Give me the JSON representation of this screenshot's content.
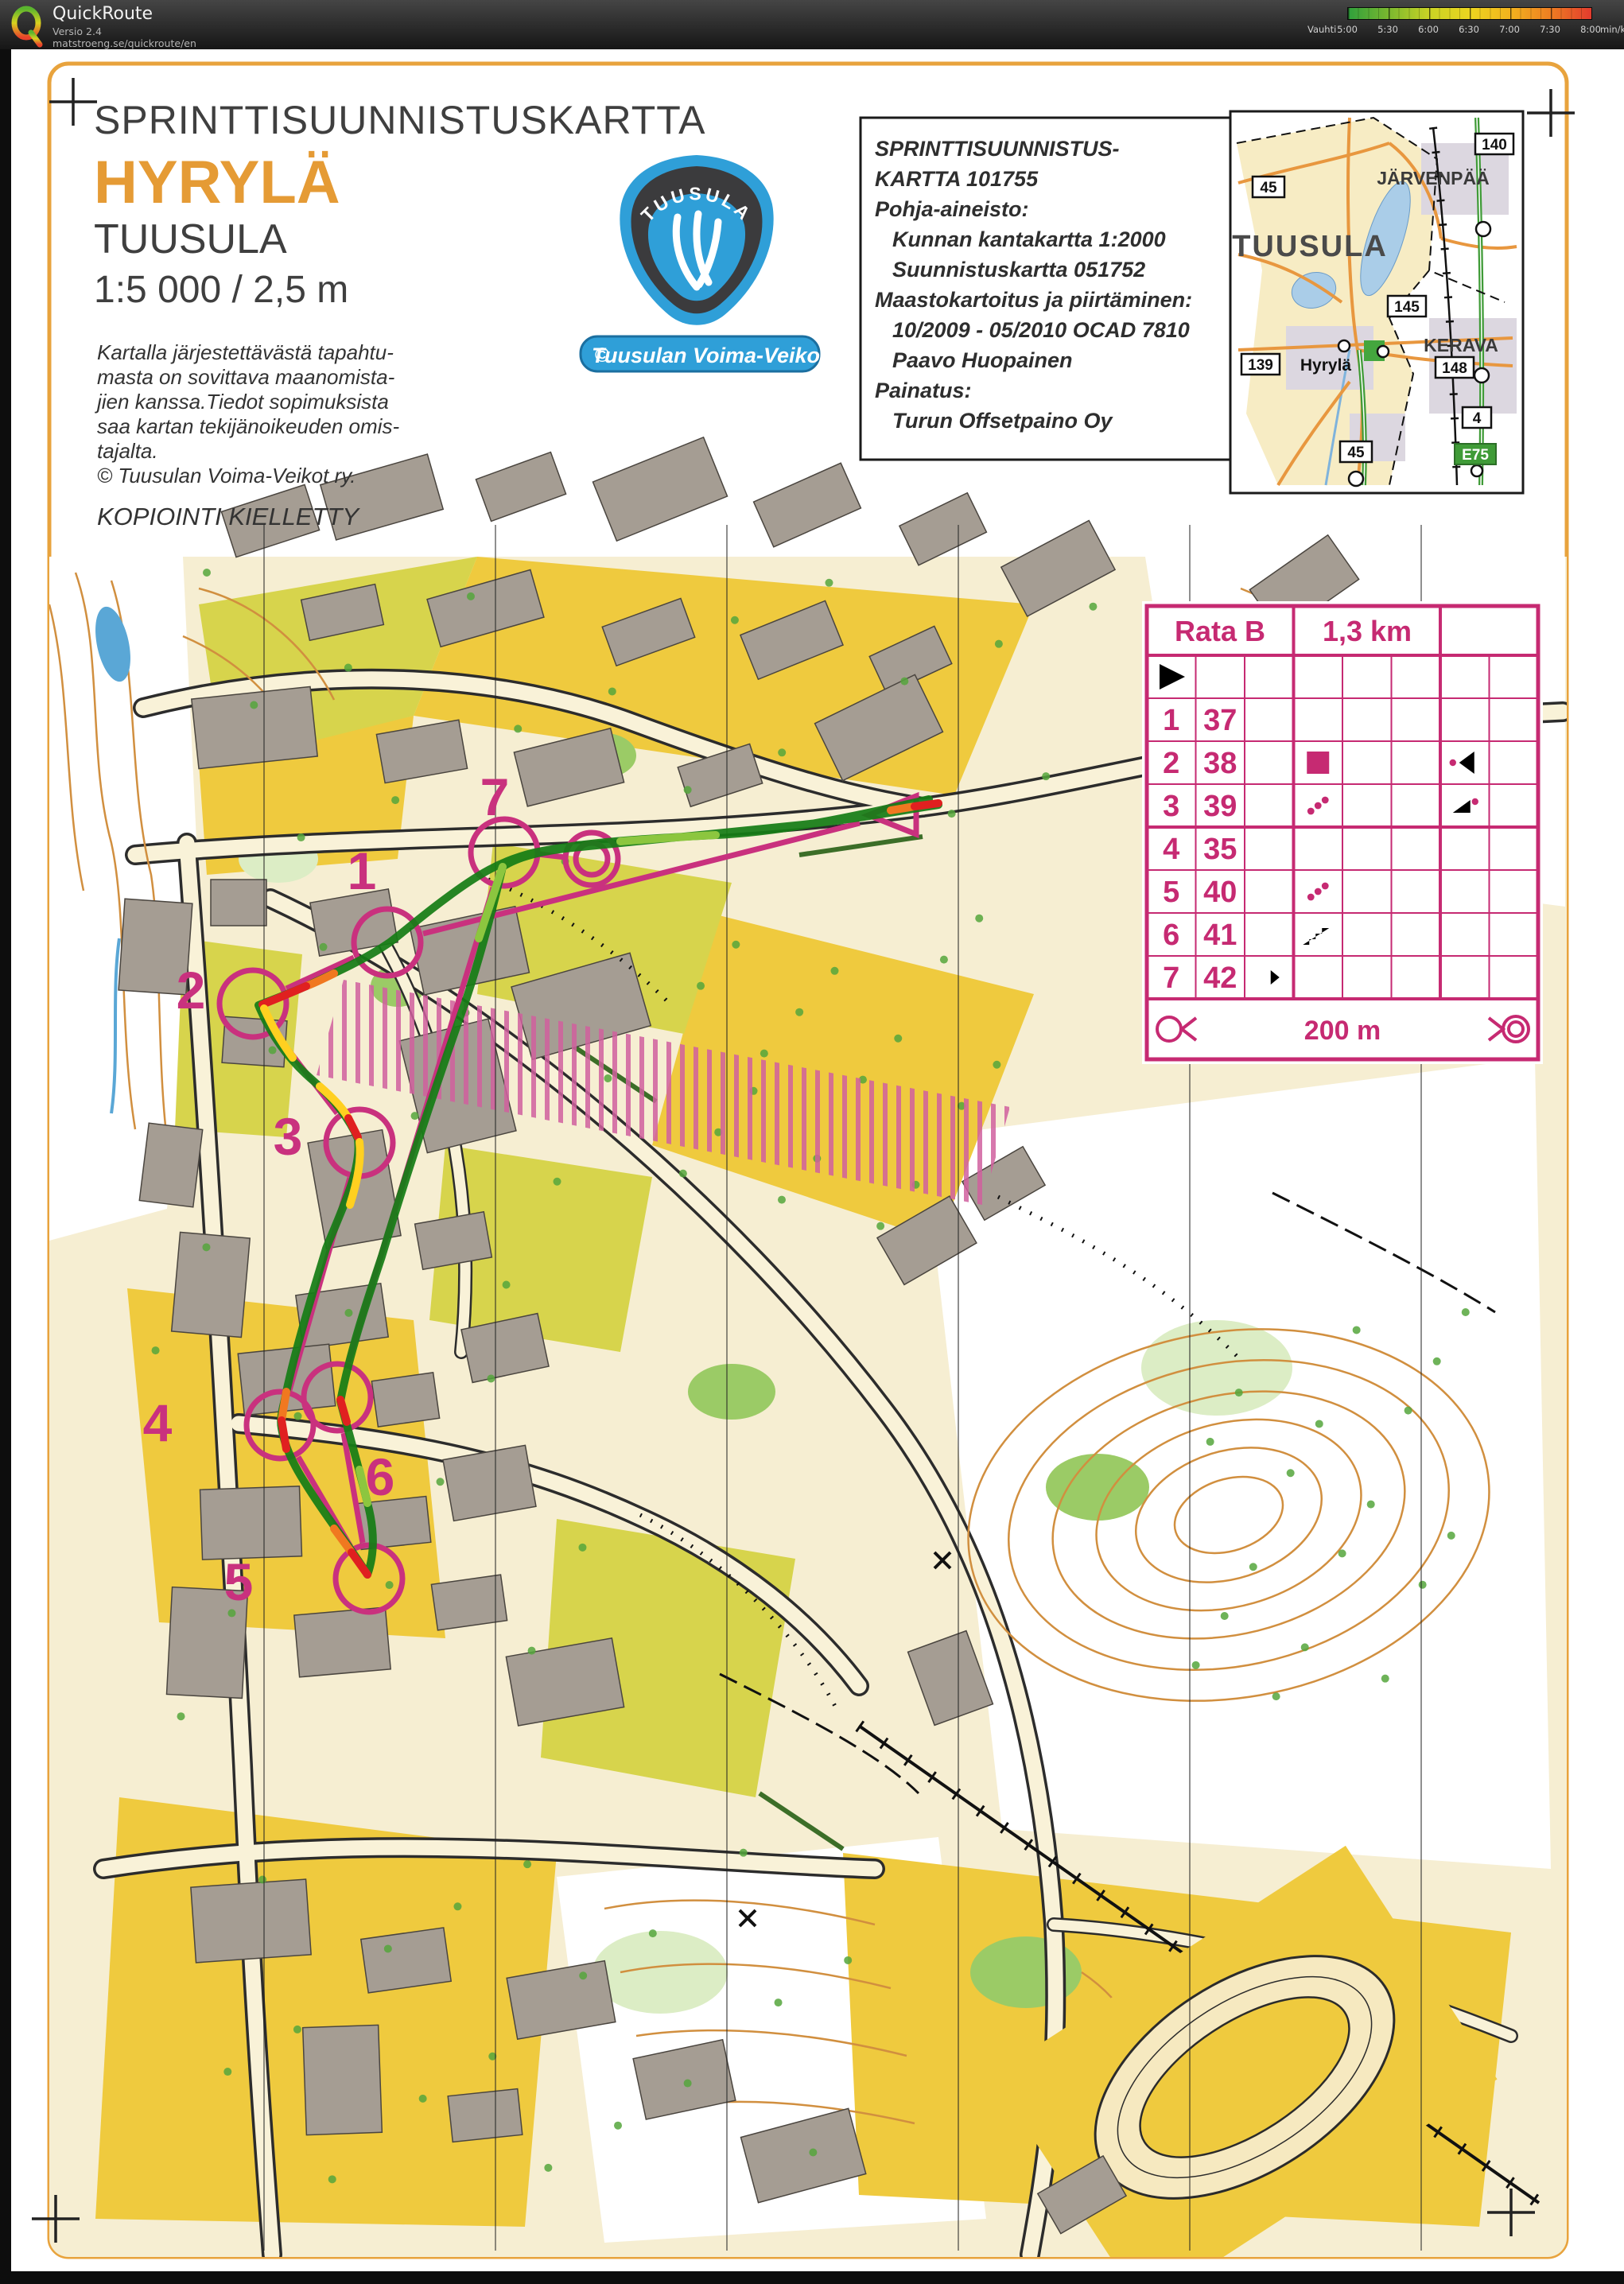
{
  "toolbar": {
    "app_name": "QuickRoute",
    "version": "Versio 2.4",
    "url": "matstroeng.se/quickroute/en",
    "legend": {
      "label": "Vauhti",
      "ticks": [
        "5:00",
        "5:30",
        "6:00",
        "6:30",
        "7:00",
        "7:30",
        "8:00"
      ],
      "unit": "min/km",
      "gradient": [
        "#2f9f3c",
        "#7ab82f",
        "#c9d325",
        "#ecd51f",
        "#f2b31e",
        "#ee7d22",
        "#e23b2e"
      ]
    }
  },
  "title_block": {
    "heading": "SPRINTTISUUNNISTUSKARTTA",
    "map_name": "HYRYLÄ",
    "municipality": "TUUSULA",
    "scale": "1:5 000 / 2,5 m",
    "copyright_lines": [
      "Kartalla järjestettävästä tapahtu-",
      "masta on sovittava maanomista-",
      "jien kanssa.Tiedot sopimuksista",
      "saa kartan tekijänoikeuden omis-",
      "tajalta.",
      "©  Tuusulan Voima-Veikot ry."
    ],
    "notice": "KOPIOINTI KIELLETTY"
  },
  "club_logo": {
    "shield_text": "TUUSULA",
    "copyright_symbol": "©",
    "banner_text": "Tuusulan Voima-Veikot",
    "blue": "#2f9fd8"
  },
  "info_box": {
    "lines": [
      {
        "text": "SPRINTTISUUNNISTUS-",
        "indent": 0
      },
      {
        "text": "KARTTA 101755",
        "indent": 0
      },
      {
        "text": "Pohja-aineisto:",
        "indent": 0
      },
      {
        "text": "Kunnan kantakartta  1:2000",
        "indent": 1
      },
      {
        "text": "Suunnistuskartta 051752",
        "indent": 1
      },
      {
        "text": "Maastokartoitus ja piirtäminen:",
        "indent": 0
      },
      {
        "text": "10/2009 - 05/2010 OCAD 7810",
        "indent": 1
      },
      {
        "text": "Paavo Huopainen",
        "indent": 1
      },
      {
        "text": "Painatus:",
        "indent": 0
      },
      {
        "text": "Turun Offsetpaino Oy",
        "indent": 1
      }
    ]
  },
  "inset_map": {
    "labels": {
      "jarvenpaa": "JÄRVENPÄÄ",
      "tuusula": "TUUSULA",
      "kerava": "KERAVA",
      "hyryla": "Hyrylä"
    },
    "road_badges": [
      {
        "text": "45"
      },
      {
        "text": "140"
      },
      {
        "text": "145"
      },
      {
        "text": "139"
      },
      {
        "text": "148"
      },
      {
        "text": "4"
      },
      {
        "text": "45"
      }
    ],
    "euro_badge": "E75"
  },
  "course_table": {
    "title": "Rata B",
    "length": "1,3 km",
    "scale_text": "200 m",
    "start_symbol": "start-triangle",
    "rows": [
      {
        "number": "1",
        "code": "37",
        "between": "",
        "feature": "thicket",
        "details": "t-right"
      },
      {
        "number": "2",
        "code": "38",
        "between": "",
        "feature": "building",
        "details": "corner-dot"
      },
      {
        "number": "3",
        "code": "39",
        "between": "",
        "feature": "hedge",
        "details": "bend-dot"
      },
      {
        "number": "4",
        "code": "35",
        "between": "",
        "feature": "wall",
        "details": "t-right"
      },
      {
        "number": "5",
        "code": "40",
        "between": "",
        "feature": "hedge",
        "details": "t-right"
      },
      {
        "number": "6",
        "code": "41",
        "between": "",
        "feature": "stairway",
        "details": ""
      },
      {
        "number": "7",
        "code": "42",
        "between": "arrow-right",
        "feature": "thicket",
        "details": "t-left"
      }
    ]
  },
  "map_course": {
    "control_numbers": [
      "1",
      "2",
      "3",
      "4",
      "5",
      "6",
      "7"
    ],
    "course_color": "#c9317e",
    "route_color": "#157d15",
    "pace_colors": {
      "fast": "#157d15",
      "medium": "#8cc63f",
      "slow": "#ffd020",
      "slower": "#f07820",
      "slowest": "#e02020"
    }
  }
}
